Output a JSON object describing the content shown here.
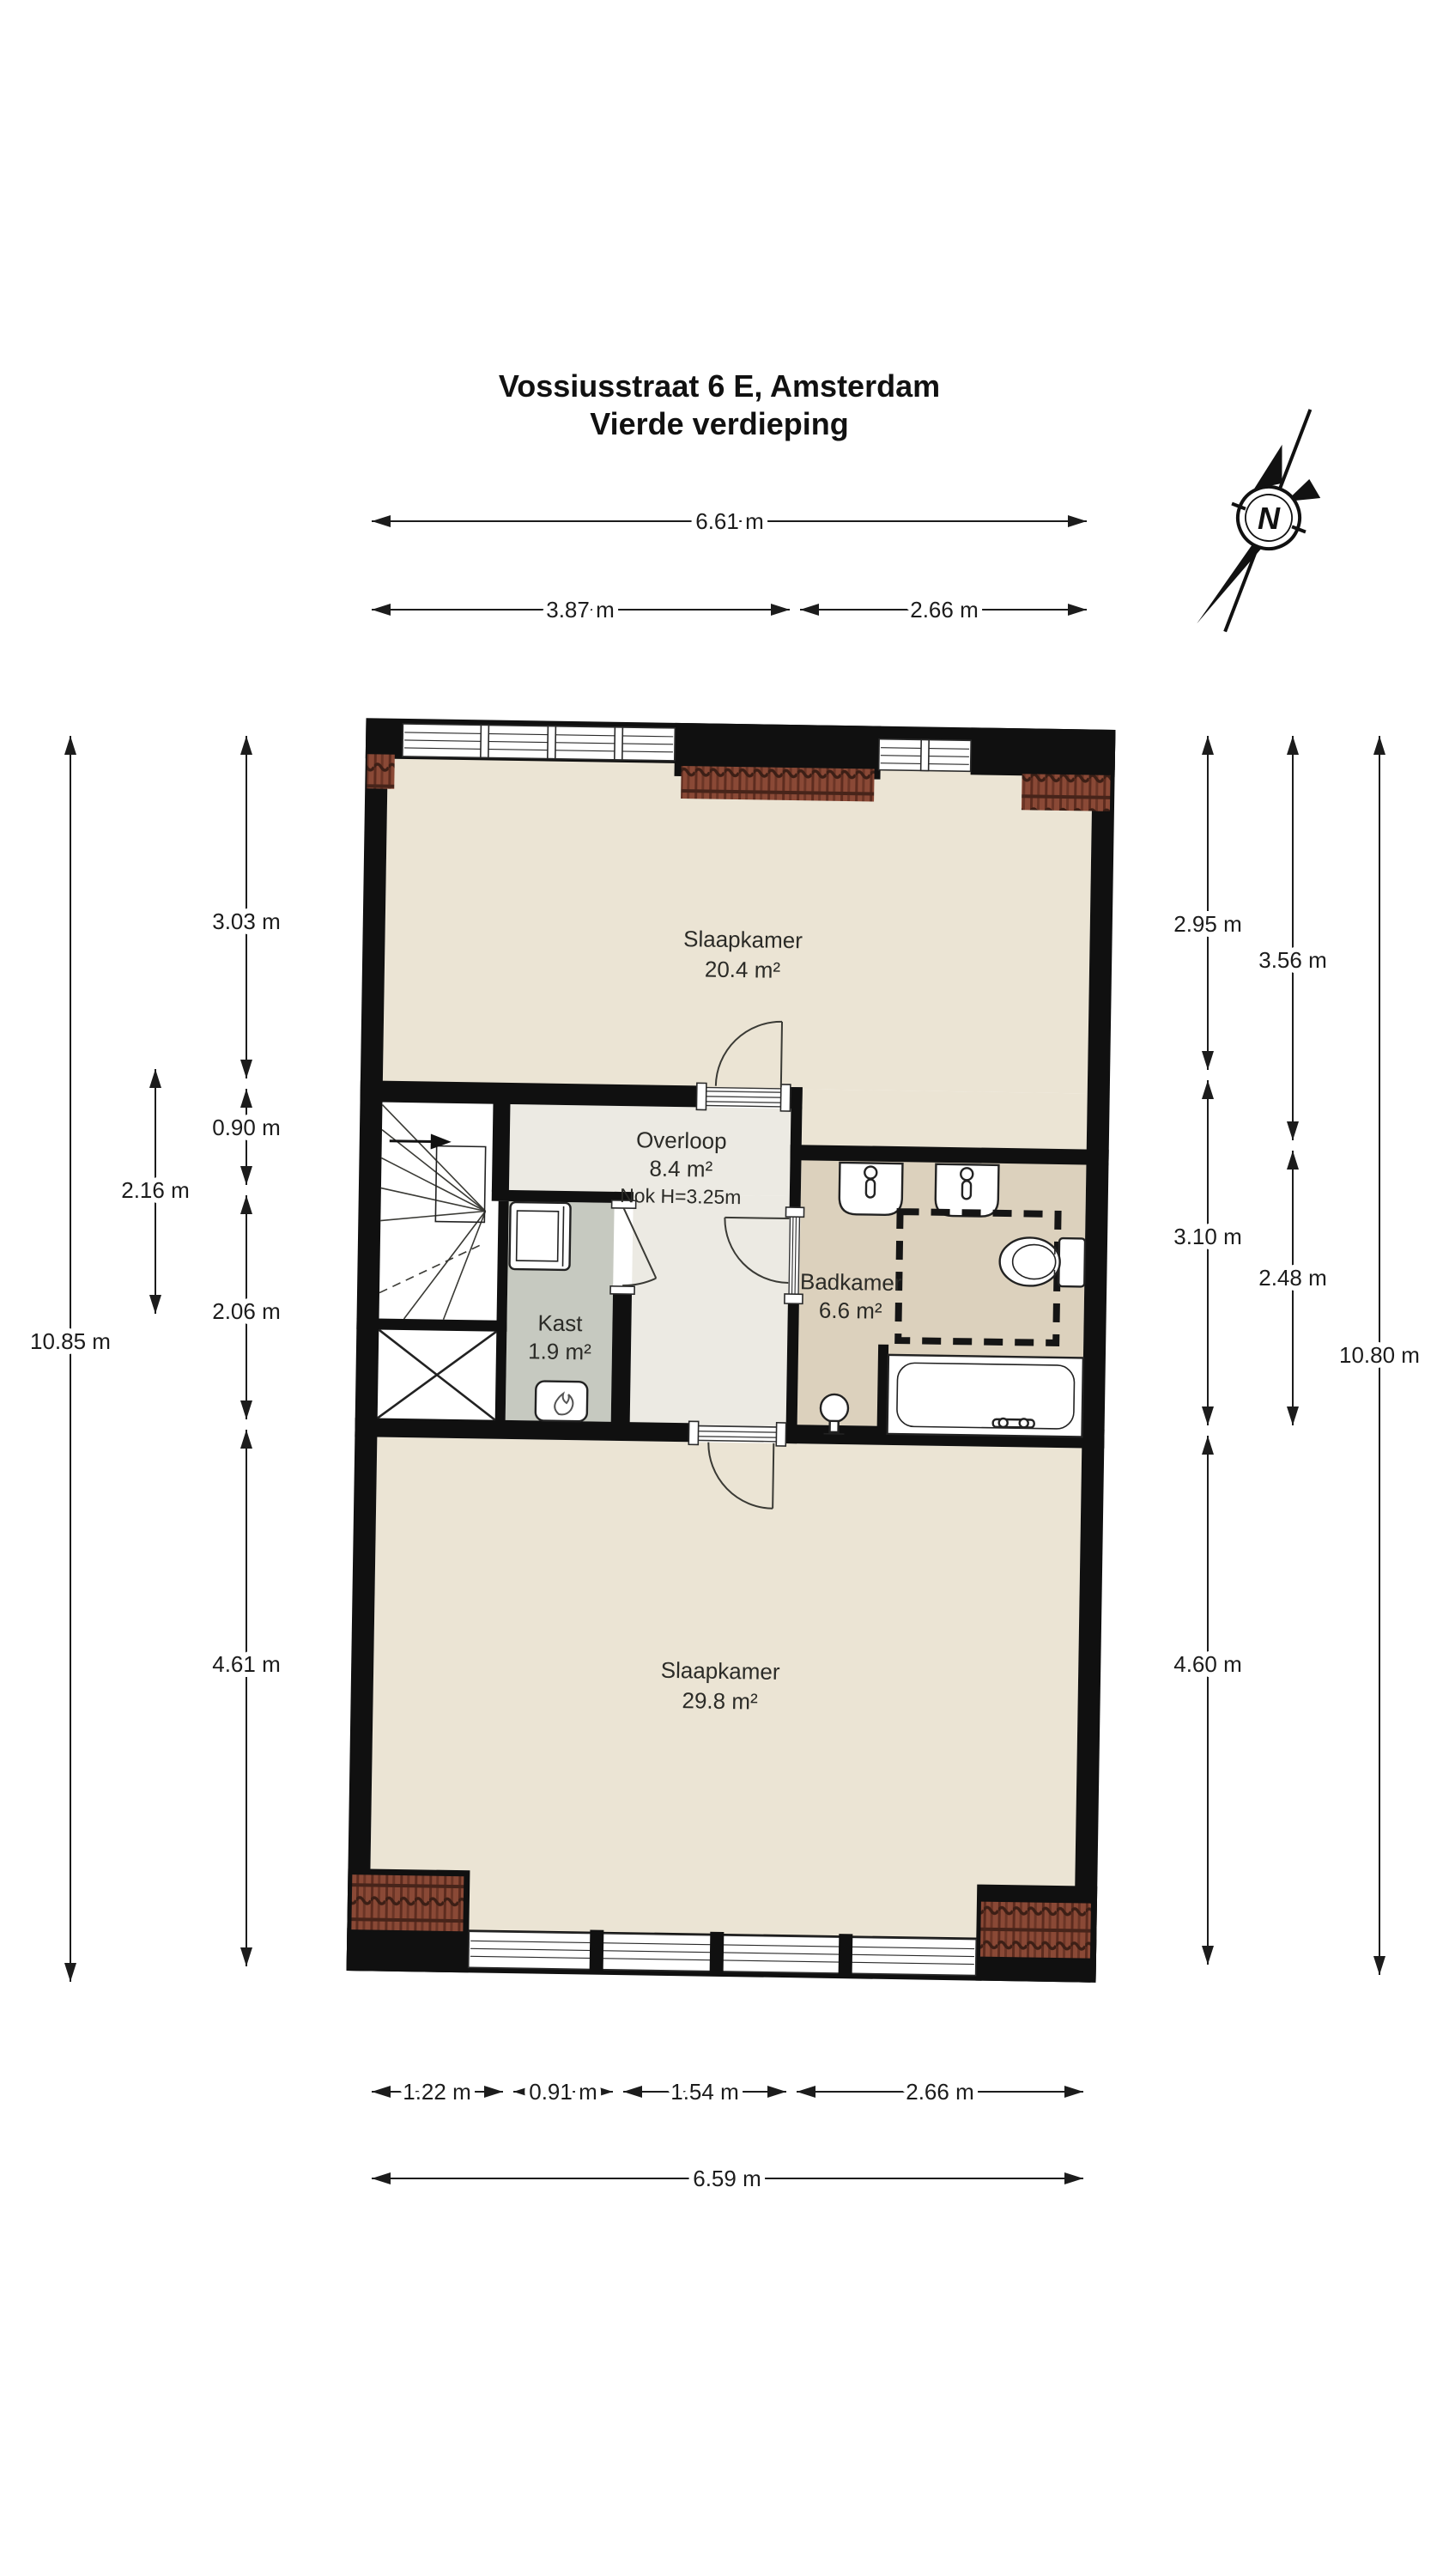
{
  "title": {
    "line1": "Vossiusstraat 6 E, Amsterdam",
    "line2": "Vierde verdieping"
  },
  "compass": {
    "label": "N"
  },
  "rooms": {
    "slaapkamer1": {
      "name": "Slaapkamer",
      "area": "20.4 m²"
    },
    "overloop": {
      "name": "Overloop",
      "area": "8.4 m²",
      "note": "Nok H=3.25m"
    },
    "badkamer": {
      "name": "Badkamer",
      "area": "6.6 m²"
    },
    "kast": {
      "name": "Kast",
      "area": "1.9 m²"
    },
    "slaapkamer2": {
      "name": "Slaapkamer",
      "area": "29.8 m²"
    }
  },
  "dimensions": {
    "top": {
      "total": "6.61 m",
      "segments": [
        "3.87 m",
        "2.66 m"
      ]
    },
    "bottom": {
      "segments": [
        "1.22 m",
        "0.91 m",
        "1.54 m",
        "2.66 m"
      ],
      "total": "6.59 m"
    },
    "left": {
      "total": "10.85 m",
      "segments": [
        "3.03 m",
        "0.90 m",
        "2.06 m",
        "4.61 m"
      ],
      "stair": "2.16 m"
    },
    "right": {
      "col1": [
        "2.95 m",
        "3.10 m",
        "4.60 m"
      ],
      "col2": [
        "3.56 m",
        "2.48 m"
      ],
      "total": "10.80 m"
    }
  },
  "colors": {
    "wall": "#101010",
    "bedroom_floor": "#ebe4d4",
    "landing_floor": "#eceae3",
    "closet_floor": "#c6c9c0",
    "bathroom_floor": "#dcd1bd",
    "roof_tiles": "#8a4936"
  }
}
